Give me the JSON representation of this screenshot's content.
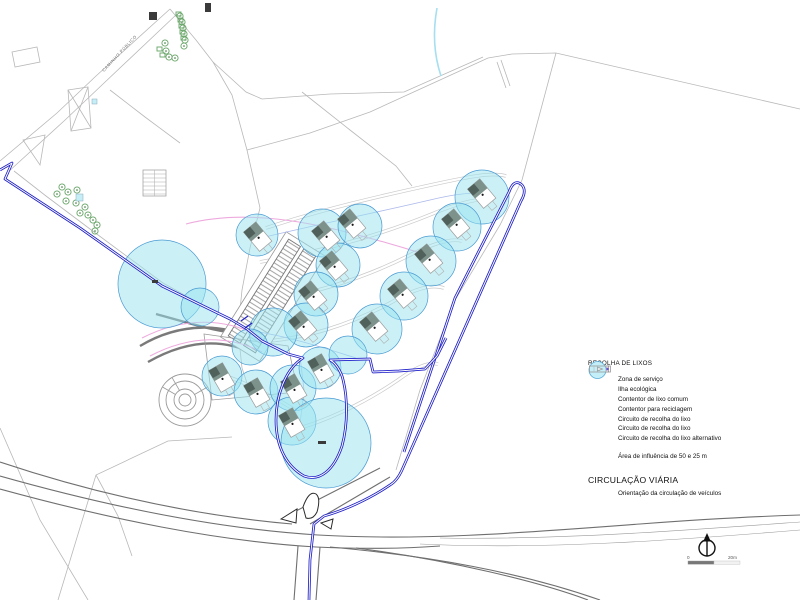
{
  "legend": {
    "title": "RECOLHA DE LIXOS",
    "items": [
      {
        "icon": "zone-a-icon",
        "label": "Zona de serviço"
      },
      {
        "icon": "eco-island-icon",
        "label": "Ilha ecológica"
      },
      {
        "icon": "container-common-icon",
        "label": "Contentor de lixo comum"
      },
      {
        "icon": "container-recycle-icon",
        "label": "Contentor para reciclagem"
      },
      {
        "icon": "line-blue-icon",
        "label": "Circuito de recolha do lixo"
      },
      {
        "icon": "line-light-icon",
        "label": "Circuito de recolha do lixo"
      },
      {
        "icon": "line-pink-icon",
        "label": "Circuito de recolha do lixo alternativo"
      },
      {
        "icon": "influence-circle-icon",
        "label": "Área de influência de 50 e 25 m"
      }
    ],
    "section2": {
      "title": "CIRCULAÇÃO VIÁRIA",
      "items": [
        {
          "icon": "arrow-box-icon",
          "label": "Orientação da circulação de veículos"
        }
      ]
    }
  },
  "scalebar": {
    "zero": "0",
    "max": "20m"
  },
  "colors": {
    "influence_fill": "#98e4f0",
    "circuit_blue": "#1e1ec8",
    "circuit_pink": "#eeaade",
    "circuit_light": "#aab8ea",
    "roof": "#7e928c",
    "roof_dark": "#50615b",
    "tree_green": "#67a567"
  },
  "map": {
    "road_label": {
      "text": "CAMINHO PÚBLICO"
    },
    "stream": "M 437,8 C 433,30 433,52 441,76",
    "boundaries": [
      "M 0,161 L 57,113 L 96,76 L 170,9",
      "M 7,173 L 64,121 L 103,84 L 177,14",
      "M 170,9 L 196,40 L 213,62 L 232,95 L 247,150 L 260,208",
      "M 247,150 L 310,133 L 370,112 L 440,80 L 488,58 L 512,54",
      "M 213,62 L 246,92 L 262,99",
      "M 262,99 L 330,94 L 404,92 L 483,57",
      "M 512,54 L 556,53 L 800,109",
      "M 556,53 L 522,180",
      "M 522,180 L 500,225 L 455,300 L 420,390 L 396,470",
      "M 12,52 L 37,47 L 40,62 L 15,67 Z",
      "M 23,140 L 45,135 L 40,165 Z",
      "M 68,90 L 88,87 L 91,128 L 71,131 Z",
      "M 68,90 L 91,128 M 88,87 L 71,131",
      "M 14,171 L 46,196 L 90,229 L 163,283 L 233,322",
      "M 110,90 L 145,117 L 180,143",
      "M 302,92 L 350,130 L 396,166 L 412,186",
      "M 260,208 L 250,248 L 242,290 L 238,330 L 242,368 L 252,398",
      "M 497,62 L 506,88 M 501,60 L 510,86",
      "M 58,600 L 96,475 L 168,441 L 232,437",
      "M 96,475 L 118,516 L 132,556",
      "M 0,428 L 40,520 L 88,600"
    ],
    "roads_light": [
      "M 266,228 C 320,210 380,196 440,183 C 468,177 492,172 506,176",
      "M 260,262 C 318,252 378,236 432,214 C 458,203 478,198 494,199",
      "M 256,302 C 308,296 362,279 408,256 C 432,244 450,238 462,241",
      "M 254,342 C 304,340 352,324 392,302 C 416,288 432,284 444,288",
      "M 286,432 C 326,422 366,402 398,380 C 416,367 428,362 438,364",
      "M 214,372 Q 240,380 262,392 Q 280,400 298,412"
    ],
    "bands": [
      "M 140,346 C 180,322 225,322 262,343",
      "M 148,362 C 190,338 228,338 262,358",
      "M 156,314 C 185,322 210,330 235,333"
    ],
    "roads_dark": [
      "M 0,476 C 110,507 220,529 318,535 C 420,541 520,533 640,524 C 720,518 770,516 800,515",
      "M 0,489 C 110,519 215,541 316,547 C 360,549 400,549 440,546",
      "M 330,547 C 430,556 520,572 600,600",
      "M 356,548 C 450,560 540,582 588,600",
      "M 0,462 C 90,492 190,515 292,524",
      "M 294,512 L 380,468",
      "M 310,524 L 390,477",
      "M 298,546 L 294,600",
      "M 320,547 L 316,600"
    ],
    "roads_faint": [
      "M 420,544 C 540,550 680,540 800,530",
      "M 440,538 C 560,540 690,530 800,522"
    ],
    "islands": [
      "M 281,519 L 297,509 L 296,523 Z",
      "M 303,507 Q 309,490 316,494 Q 321,498 317,512 Q 313,520 306,518 Z",
      "M 321,523 L 333,519 L 331,529 Z"
    ],
    "routes_pink": [
      "M 186,224 C 240,210 300,220 350,233 C 390,243 418,252 442,260",
      "M 142,338 C 185,316 228,318 262,338",
      "M 150,356 C 192,334 230,336 262,352"
    ],
    "routes_light": [
      "M 252,240 C 310,226 370,214 430,200 C 455,194 472,192 486,194",
      "M 246,330 C 290,336 330,350 356,358",
      "M 300,356 L 304,390 L 300,424"
    ],
    "routes_blue": [
      "M 0,170 L 12,163 L 5,179 L 80,228 L 162,286 L 230,319 L 247,329",
      "M 404,452 L 455,298 L 509,192 Q 514,178 522,185 Q 527,191 521,201 L 402,470 Q 397,481 390,485",
      "M 390,485 C 368,500 342,511 324,516 L 314,524 L 310,560 L 309,600",
      "M 247,329 L 262,341 L 288,354 L 303,358 C 284,370 276,398 276,420 C 276,446 286,466 304,476 C 320,482 334,470 342,446 C 348,424 348,396 342,376 C 338,366 334,362 330,360 L 370,359 L 373,372 L 399,371 L 425,369 L 437,356 L 446,338"
    ],
    "blue_ticks": [
      "M 241,321 L 248,316",
      "M 245,328 L 252,323"
    ],
    "influence_circles": [
      [
        162,
        284,
        44
      ],
      [
        200,
        307,
        19
      ],
      [
        257,
        235,
        21
      ],
      [
        322,
        233,
        24
      ],
      [
        360,
        226,
        22
      ],
      [
        338,
        265,
        22
      ],
      [
        316,
        294,
        22
      ],
      [
        306,
        325,
        22
      ],
      [
        482,
        197,
        27
      ],
      [
        457,
        227,
        24
      ],
      [
        431,
        261,
        25
      ],
      [
        404,
        296,
        24
      ],
      [
        377,
        329,
        25
      ],
      [
        273,
        332,
        24
      ],
      [
        222,
        376,
        20
      ],
      [
        256,
        392,
        22
      ],
      [
        293,
        388,
        23
      ],
      [
        320,
        368,
        21
      ],
      [
        292,
        421,
        24
      ],
      [
        326,
        443,
        45
      ],
      [
        250,
        347,
        18
      ],
      [
        348,
        355,
        19
      ]
    ],
    "houses": [
      [
        482,
        194,
        -40
      ],
      [
        456,
        224,
        -40
      ],
      [
        429,
        259,
        -40
      ],
      [
        402,
        294,
        -40
      ],
      [
        374,
        327,
        -40
      ],
      [
        352,
        224,
        -40
      ],
      [
        326,
        236,
        -40
      ],
      [
        334,
        266,
        -40
      ],
      [
        313,
        296,
        -40
      ],
      [
        303,
        326,
        -40
      ],
      [
        222,
        378,
        -30
      ],
      [
        257,
        393,
        -30
      ],
      [
        294,
        389,
        -30
      ],
      [
        321,
        369,
        -30
      ],
      [
        292,
        423,
        -30
      ],
      [
        258,
        237,
        -40
      ]
    ],
    "parking": {
      "cx": 272,
      "cy": 296,
      "rot": 32
    },
    "plaza": {
      "d": "M 204,334 L 288,346 L 298,392 L 212,400 Z"
    },
    "grid_building": {
      "x": 143,
      "y": 170,
      "w": 23,
      "h": 26
    },
    "roundabout": {
      "cx": 185,
      "cy": 400,
      "radii": [
        26,
        19,
        11,
        6
      ]
    },
    "trees": [
      [
        62,
        187
      ],
      [
        57,
        194
      ],
      [
        68,
        192
      ],
      [
        77,
        190
      ],
      [
        66,
        201
      ],
      [
        76,
        203
      ],
      [
        85,
        207
      ],
      [
        80,
        213
      ],
      [
        88,
        215
      ],
      [
        93,
        220
      ],
      [
        97,
        225
      ],
      [
        95,
        231
      ],
      [
        165,
        43
      ],
      [
        166,
        51
      ],
      [
        169,
        57
      ],
      [
        175,
        58
      ],
      [
        180,
        16
      ],
      [
        182,
        22
      ],
      [
        183,
        28
      ],
      [
        184,
        34
      ],
      [
        185,
        40
      ],
      [
        184,
        46
      ]
    ],
    "hedges": [
      [
        176,
        12,
        5,
        4
      ],
      [
        178,
        18,
        5,
        4
      ],
      [
        179,
        24,
        5,
        4
      ],
      [
        180,
        30,
        5,
        4
      ],
      [
        181,
        36,
        5,
        4
      ],
      [
        157,
        47,
        5,
        4
      ],
      [
        160,
        53,
        5,
        4
      ]
    ],
    "dark_squares": [
      [
        149,
        12,
        8,
        8
      ],
      [
        205,
        3,
        6,
        9
      ],
      [
        318,
        441,
        8,
        3
      ],
      [
        152,
        280,
        6,
        3
      ]
    ],
    "cyan_squares": [
      [
        76,
        194,
        7,
        7
      ],
      [
        92,
        99,
        5,
        5
      ]
    ]
  }
}
